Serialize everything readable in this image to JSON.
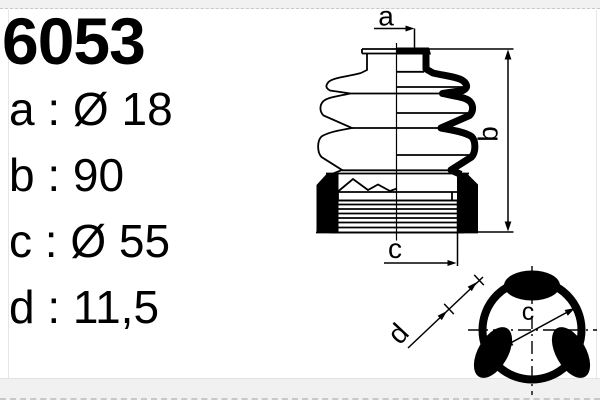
{
  "part": {
    "number": "6053"
  },
  "dimensions": [
    {
      "key": "a",
      "text": "a : Ø 18"
    },
    {
      "key": "b",
      "text": "b : 90"
    },
    {
      "key": "c",
      "text": "c : Ø 55"
    },
    {
      "key": "d",
      "text": "d : 11,5"
    }
  ],
  "diagram": {
    "side_view": {
      "a_label": "a",
      "b_label": "b",
      "c_label": "c"
    },
    "section_view": {
      "d_label": "d",
      "diameter_label": "c"
    }
  },
  "colors": {
    "ink": "#000000",
    "band_bg": "#f1f1f1",
    "frame_line": "#e6e6e6"
  }
}
